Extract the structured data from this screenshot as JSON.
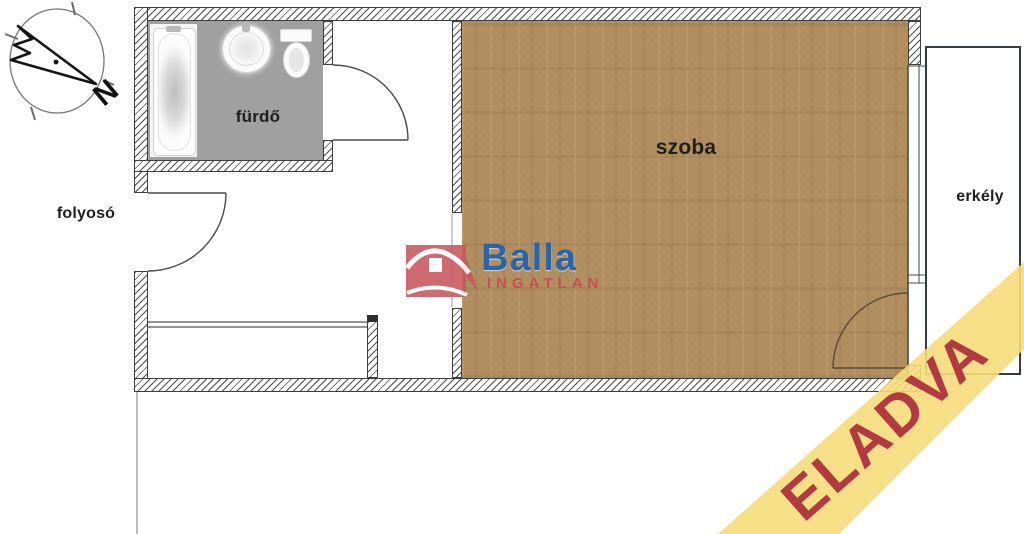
{
  "plan": {
    "rooms": {
      "bathroom": "fürdő",
      "corridor": "folyosó",
      "room": "szoba",
      "balcony": "erkély"
    },
    "compass": {
      "north_letter": "N"
    }
  },
  "watermark": {
    "brand": "Balla",
    "brand_sub": "INGATLAN"
  },
  "banner": {
    "label": "ELADVA"
  },
  "colors": {
    "wood_floor": "#b28f61",
    "bathroom_floor": "#a0a0a0",
    "banner_yellow": "#f6db7a",
    "banner_text": "#b23a41",
    "logo_blue": "#2063ad",
    "logo_red": "#c64d50",
    "wall_line": "#3e3e3e"
  }
}
